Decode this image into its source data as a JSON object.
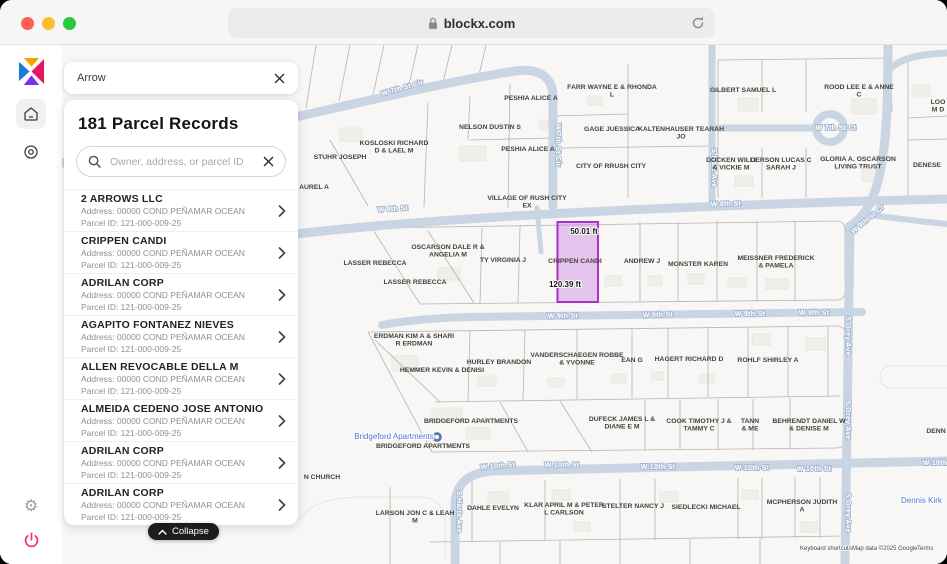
{
  "browser": {
    "url": "blockx.com"
  },
  "panel_header": {
    "title": "Arrow"
  },
  "panel": {
    "records_title": "181 Parcel Records",
    "search_placeholder": "Owner, address, or parcel ID",
    "collapse_label": "Collapse",
    "records": [
      {
        "name": "2 ARROWS LLC",
        "address": "Address: 00000 COND PEÑAMAR OCEAN",
        "parcel_id": "Parcel ID: 121-000-009-25"
      },
      {
        "name": "CRIPPEN CANDI",
        "address": "Address: 00000 COND PEÑAMAR OCEAN",
        "parcel_id": "Parcel ID: 121-000-009-25"
      },
      {
        "name": "ADRILAN CORP",
        "address": "Address: 00000 COND PEÑAMAR OCEAN",
        "parcel_id": "Parcel ID: 121-000-009-25"
      },
      {
        "name": "AGAPITO FONTANEZ NIEVES",
        "address": "Address: 00000 COND PEÑAMAR OCEAN",
        "parcel_id": "Parcel ID: 121-000-009-25"
      },
      {
        "name": "ALLEN REVOCABLE DELLA M",
        "address": "Address: 00000 COND PEÑAMAR OCEAN",
        "parcel_id": "Parcel ID: 121-000-009-25"
      },
      {
        "name": "ALMEIDA CEDENO JOSE ANTONIO",
        "address": "Address: 00000 COND PEÑAMAR OCEAN",
        "parcel_id": "Parcel ID: 121-000-009-25"
      },
      {
        "name": "ADRILAN CORP",
        "address": "Address: 00000 COND PEÑAMAR OCEAN",
        "parcel_id": "Parcel ID: 121-000-009-25"
      },
      {
        "name": "ADRILAN CORP",
        "address": "Address: 00000 COND PEÑAMAR OCEAN",
        "parcel_id": "Parcel ID: 121-000-009-25"
      }
    ]
  },
  "map": {
    "highlight": {
      "owner": "CRIPPEN CANDI",
      "width_label": "50.01 ft",
      "length_label": "120.39 ft",
      "fill": "#c77de0",
      "stroke": "#a832c8"
    },
    "street_labels": [
      {
        "text": "W 7th St Cir",
        "x": 403,
        "y": 90,
        "rot": -16
      },
      {
        "text": "W 7th St Cir",
        "x": 556,
        "y": 145,
        "rot": 90
      },
      {
        "text": "W 8th St",
        "x": 393,
        "y": 211,
        "rot": -4
      },
      {
        "text": "W 8th St",
        "x": 726,
        "y": 206,
        "rot": -2
      },
      {
        "text": "W 9th St",
        "x": 563,
        "y": 318,
        "rot": -1
      },
      {
        "text": "W 9th St",
        "x": 658,
        "y": 317,
        "rot": -1
      },
      {
        "text": "W 9th St",
        "x": 750,
        "y": 316,
        "rot": 0
      },
      {
        "text": "W 9th St",
        "x": 814,
        "y": 315,
        "rot": 0
      },
      {
        "text": "W 10th St",
        "x": 498,
        "y": 468,
        "rot": -5
      },
      {
        "text": "W 10th St",
        "x": 562,
        "y": 467,
        "rot": -1
      },
      {
        "text": "W 10th St",
        "x": 658,
        "y": 469,
        "rot": 0
      },
      {
        "text": "W 10th St",
        "x": 752,
        "y": 470,
        "rot": 0
      },
      {
        "text": "W 10th St",
        "x": 814,
        "y": 471,
        "rot": 0
      },
      {
        "text": "W 10th St",
        "x": 940,
        "y": 465,
        "rot": 0
      },
      {
        "text": "S Hare Ave",
        "x": 712,
        "y": 168,
        "rot": 90
      },
      {
        "text": "S Harte Ave",
        "x": 457,
        "y": 512,
        "rot": 90
      },
      {
        "text": "S Grey Ave",
        "x": 846,
        "y": 336,
        "rot": 90
      },
      {
        "text": "S Grey Ave",
        "x": 846,
        "y": 420,
        "rot": 90
      },
      {
        "text": "S Grey Ave",
        "x": 846,
        "y": 513,
        "rot": 90
      },
      {
        "text": "W 7th St Ct",
        "x": 836,
        "y": 130,
        "rot": 0
      },
      {
        "text": "W 9th St Cr",
        "x": 869,
        "y": 221,
        "rot": -40
      }
    ],
    "parcel_labels": [
      {
        "text": "PESHIA ALICE A",
        "x": 531,
        "y": 100
      },
      {
        "text": "FARR WAYNE E & RHONDA\nL",
        "x": 612,
        "y": 89
      },
      {
        "text": "GILBERT SAMUEL L",
        "x": 743,
        "y": 92
      },
      {
        "text": "ROOD LEE E & ANNE\nC",
        "x": 859,
        "y": 89
      },
      {
        "text": "LOO\nM D",
        "x": 938,
        "y": 104
      },
      {
        "text": "NELSON DUSTIN S",
        "x": 490,
        "y": 129
      },
      {
        "text": "GAGE JUESSICA",
        "x": 612,
        "y": 131
      },
      {
        "text": "KALTENHAUSER TEARAH\nJO",
        "x": 681,
        "y": 131
      },
      {
        "text": "PESHIA ALICE A",
        "x": 528,
        "y": 151
      },
      {
        "text": "CITY OF RRUSH CITY",
        "x": 611,
        "y": 168
      },
      {
        "text": "DOCKEN WILLI\n& VICKIE M",
        "x": 731,
        "y": 162
      },
      {
        "text": "DERSON LUCAS C\nSARAH J",
        "x": 781,
        "y": 162
      },
      {
        "text": "GLORIA A. OSCARSON\nLIVING TRUST",
        "x": 858,
        "y": 161
      },
      {
        "text": "DENESE",
        "x": 927,
        "y": 167
      },
      {
        "text": "STUHR JOSEPH",
        "x": 340,
        "y": 159
      },
      {
        "text": "KOSLOSKI RICHARD\nD & LAEL M",
        "x": 394,
        "y": 145
      },
      {
        "text": "AUREL A",
        "x": 314,
        "y": 189
      },
      {
        "text": "VILLAGE OF RUSH CITY\nEX",
        "x": 527,
        "y": 200
      },
      {
        "text": "OSCARSON DALE R &\nANGELIA M",
        "x": 448,
        "y": 249
      },
      {
        "text": "LASSER REBECCA",
        "x": 375,
        "y": 265
      },
      {
        "text": "LASSER REBECCA",
        "x": 415,
        "y": 284
      },
      {
        "text": "TY VIRGINIA J",
        "x": 503,
        "y": 262
      },
      {
        "text": "CRIPPEN CANDI",
        "x": 575,
        "y": 263
      },
      {
        "text": "ANDREW J",
        "x": 642,
        "y": 263
      },
      {
        "text": "MONSTER KAREN",
        "x": 698,
        "y": 266
      },
      {
        "text": "MEISSNER FREDERICK\n& PAMELA",
        "x": 776,
        "y": 260
      },
      {
        "text": "ERDMAN KIM A & SHARI\nR ERDMAN",
        "x": 414,
        "y": 338
      },
      {
        "text": "HURLEY BRANDON",
        "x": 499,
        "y": 364
      },
      {
        "text": "HEMMER KEVIN & DENISI",
        "x": 442,
        "y": 372
      },
      {
        "text": "VANDERSCHAEGEN ROBBE\n& YVONNE",
        "x": 577,
        "y": 357
      },
      {
        "text": "EAN G",
        "x": 632,
        "y": 362
      },
      {
        "text": "HAGERT RICHARD D",
        "x": 689,
        "y": 361
      },
      {
        "text": "ROHLF SHIRLEY A",
        "x": 768,
        "y": 362
      },
      {
        "text": "BRIDGEFORD APARTMENTS",
        "x": 471,
        "y": 423
      },
      {
        "text": "BRIDGEFORD APARTMENTS",
        "x": 423,
        "y": 448
      },
      {
        "text": "DUFECK JAMES L &\nDIANE E M",
        "x": 622,
        "y": 421
      },
      {
        "text": "COOK TIMOTHY J &\nTAMMY C",
        "x": 699,
        "y": 423
      },
      {
        "text": "TANN\n& ME",
        "x": 750,
        "y": 423
      },
      {
        "text": "BEHRENDT DANIEL W\n& DENISE M",
        "x": 809,
        "y": 423
      },
      {
        "text": "N CHURCH",
        "x": 322,
        "y": 479
      },
      {
        "text": "LARSON JON C & LEAH\nM",
        "x": 415,
        "y": 515
      },
      {
        "text": "DAHLE EVELYN",
        "x": 493,
        "y": 510
      },
      {
        "text": "KLAR APRIL M & PETER\nL CARLSON",
        "x": 564,
        "y": 507
      },
      {
        "text": "STELTER NANCY J",
        "x": 633,
        "y": 508
      },
      {
        "text": "SIEDLECKI MICHAEL",
        "x": 706,
        "y": 509
      },
      {
        "text": "MCPHERSON JUDITH\nA",
        "x": 802,
        "y": 504
      },
      {
        "text": "DENN",
        "x": 936,
        "y": 433
      }
    ],
    "poi_labels": [
      {
        "text": "Bridgeford Apartments",
        "x": 394,
        "y": 439,
        "anchor": "middle"
      },
      {
        "text": "Dennis Kirk",
        "x": 901,
        "y": 503,
        "anchor": "start"
      }
    ],
    "attribution": {
      "keyboard_shortcuts": "Keyboard shortcuts",
      "map_data": "Map data ©2025 Google",
      "terms": "Terms"
    }
  },
  "colors": {
    "street": "#c9d5e3",
    "highlight_stroke": "#a832c8",
    "poi_blue": "#4d76d0",
    "collapse_bg": "#1c1c1e",
    "power_pink": "#f6336b"
  }
}
